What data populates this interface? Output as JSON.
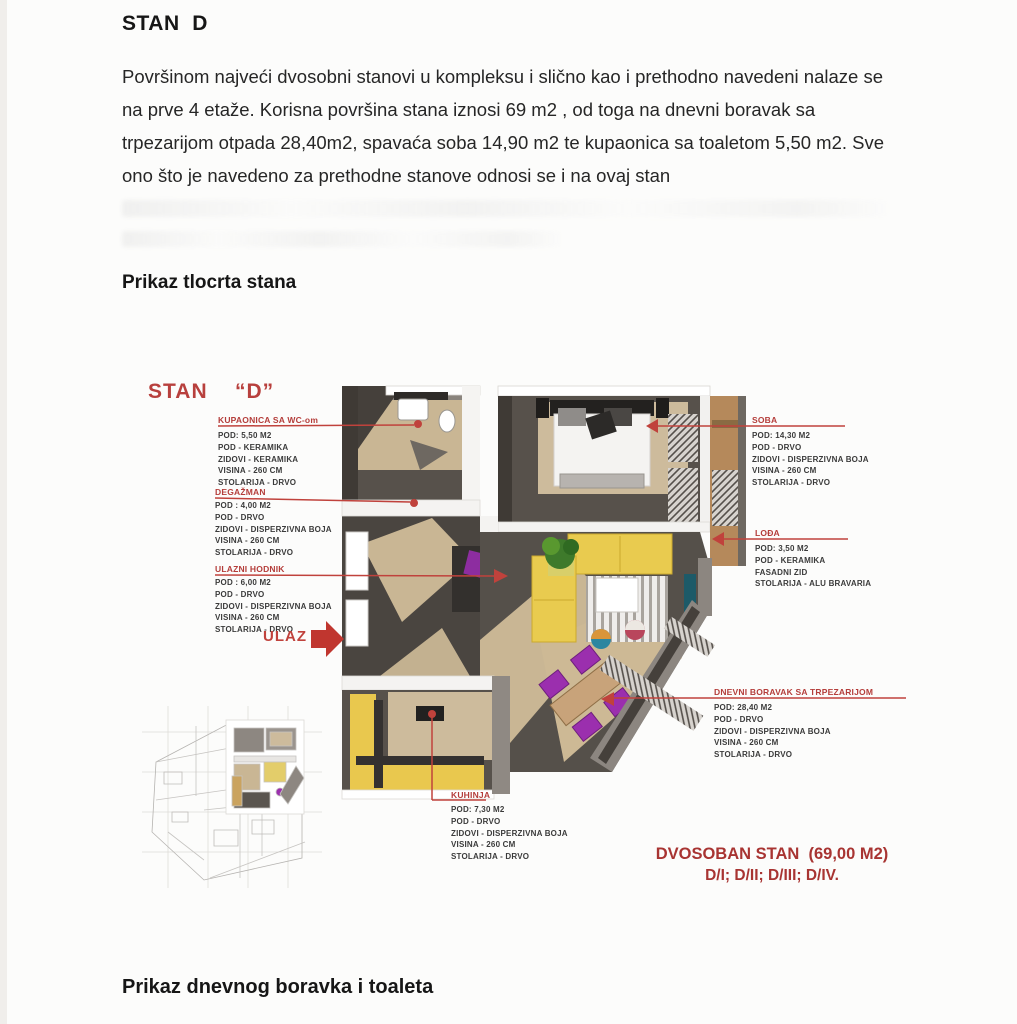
{
  "document": {
    "title": "STAN  D",
    "intro_paragraph": "Površinom najveći dvosobni stanovi u kompleksu i slično kao i prethodno navedeni nalaze se na prve 4 etaže. Korisna površina stana iznosi 69 m2 , od toga na dnevni boravak sa trpezarijom otpada 28,40m2, spavaća soba 14,90 m2 te kupaonica sa toaletom 5,50 m2. Sve ono što je navedeno za prethodne stanove odnosi se i na ovaj stan",
    "plan_section_heading": "Prikaz tlocrta stana",
    "bottom_section_heading": "Prikaz dnevnog boravka i toaleta"
  },
  "floorplan": {
    "plan_title": "STAN    “D”",
    "entrance_label": "ULAZ",
    "type_summary": "DVOSOBAN STAN  (69,00 M2)",
    "units_list": "D/I; D/II; D/III; D/IV.",
    "labels": [
      {
        "name": "KUPAONICA SA WC-om",
        "lines": [
          "POD: 5,50 M2",
          "POD - KERAMIKA",
          "ZIDOVI - KERAMIKA",
          "VISINA - 260 CM",
          "STOLARIJA - DRVO"
        ]
      },
      {
        "name": "DEGAŽMAN",
        "lines": [
          "POD : 4,00 M2",
          "POD - DRVO",
          "ZIDOVI - DISPERZIVNA BOJA",
          "VISINA - 260 CM",
          "STOLARIJA - DRVO"
        ]
      },
      {
        "name": "ULAZNI HODNIK",
        "lines": [
          "POD : 6,00 M2",
          "POD - DRVO",
          "ZIDOVI - DISPERZIVNA BOJA",
          "VISINA - 260 CM",
          "STOLARIJA - DRVO"
        ]
      },
      {
        "name": "SOBA",
        "lines": [
          "POD: 14,30 M2",
          "POD - DRVO",
          "ZIDOVI - DISPERZIVNA BOJA",
          "VISINA - 260 CM",
          "STOLARIJA - DRVO"
        ]
      },
      {
        "name": "LOĐA",
        "lines": [
          "POD: 3,50 M2",
          "POD - KERAMIKA",
          "FASADNI ZID",
          "STOLARIJA - ALU BRAVARIA"
        ]
      },
      {
        "name": "DNEVNI BORAVAK SA TRPEZARIJOM",
        "lines": [
          "POD: 28,40 M2",
          "POD - DRVO",
          "ZIDOVI - DISPERZIVNA BOJA",
          "VISINA - 260 CM",
          "STOLARIJA - DRVO"
        ]
      },
      {
        "name": "KUHINJA",
        "lines": [
          "POD: 7,30 M2",
          "POD - DRVO",
          "ZIDOVI - DISPERZIVNA BOJA",
          "VISINA - 260 CM",
          "STOLARIJA - DRVO"
        ]
      }
    ],
    "colors": {
      "accent_red": "#b43d3a",
      "wall_dark": "#413c37",
      "floor_beige": "#cdbb9c",
      "sofa_yellow": "#e9cb4f",
      "chair_purple": "#9b2fae"
    }
  }
}
